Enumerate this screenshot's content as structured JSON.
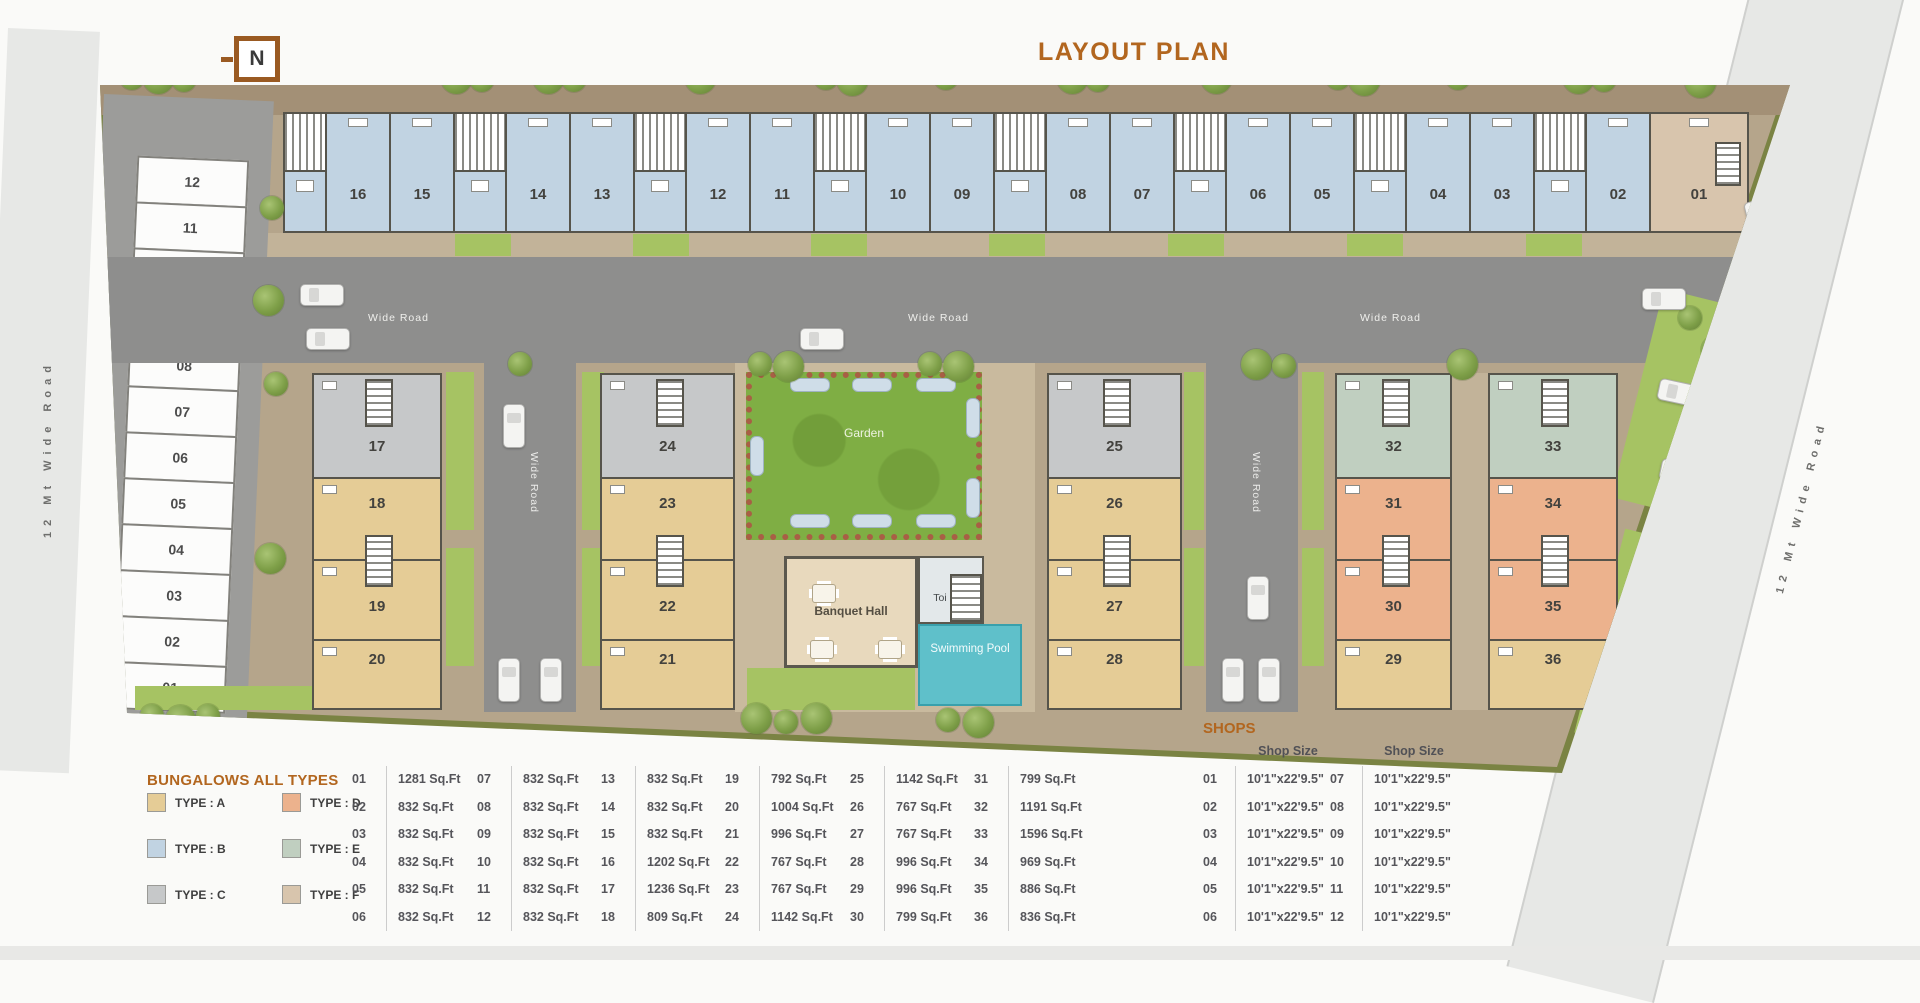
{
  "title": "LAYOUT PLAN",
  "north_label": "N",
  "accent_color": "#b2661f",
  "roads": {
    "left_label": "12 Mt Wide Road",
    "right_label": "12 Mt Wide Road",
    "horizontal_label": "Wide Road",
    "vertical_label": "Wide Road"
  },
  "amenities": {
    "garden": "Garden",
    "banquet_hall": "Banquet Hall",
    "toilet": "Toi",
    "swimming_pool": "Swimming Pool"
  },
  "top_row_units": [
    {
      "no": "16",
      "type": "B"
    },
    {
      "no": "15",
      "type": "B"
    },
    {
      "no": "14",
      "type": "B"
    },
    {
      "no": "13",
      "type": "B"
    },
    {
      "no": "12",
      "type": "B"
    },
    {
      "no": "11",
      "type": "B"
    },
    {
      "no": "10",
      "type": "B"
    },
    {
      "no": "09",
      "type": "B"
    },
    {
      "no": "08",
      "type": "B"
    },
    {
      "no": "07",
      "type": "B"
    },
    {
      "no": "06",
      "type": "B"
    },
    {
      "no": "05",
      "type": "B"
    },
    {
      "no": "04",
      "type": "B"
    },
    {
      "no": "03",
      "type": "B"
    },
    {
      "no": "02",
      "type": "B"
    },
    {
      "no": "01",
      "type": "F"
    }
  ],
  "clusters": [
    {
      "units": [
        {
          "no": "17",
          "type": "C"
        },
        {
          "no": "18",
          "type": "A"
        },
        {
          "no": "19",
          "type": "A"
        },
        {
          "no": "20",
          "type": "A"
        }
      ]
    },
    {
      "units": [
        {
          "no": "24",
          "type": "C"
        },
        {
          "no": "23",
          "type": "A"
        },
        {
          "no": "22",
          "type": "A"
        },
        {
          "no": "21",
          "type": "A"
        }
      ]
    },
    {
      "units": [
        {
          "no": "25",
          "type": "C"
        },
        {
          "no": "26",
          "type": "A"
        },
        {
          "no": "27",
          "type": "A"
        },
        {
          "no": "28",
          "type": "A"
        }
      ]
    },
    {
      "units": [
        {
          "no": "32",
          "type": "E"
        },
        {
          "no": "31",
          "type": "D"
        },
        {
          "no": "30",
          "type": "D"
        },
        {
          "no": "29",
          "type": "A"
        }
      ]
    },
    {
      "units": [
        {
          "no": "33",
          "type": "E"
        },
        {
          "no": "34",
          "type": "D"
        },
        {
          "no": "35",
          "type": "D"
        },
        {
          "no": "36",
          "type": "A"
        }
      ]
    }
  ],
  "shop_slots": [
    "12",
    "11",
    "10",
    "09",
    "08",
    "07",
    "06",
    "05",
    "04",
    "03",
    "02",
    "01"
  ],
  "legend": {
    "title": "BUNGALOWS ALL TYPES",
    "items": [
      {
        "label": "TYPE : A",
        "color": "#e5cc96"
      },
      {
        "label": "TYPE : B",
        "color": "#c1d3e2"
      },
      {
        "label": "TYPE : C",
        "color": "#c6c8c9"
      },
      {
        "label": "TYPE : D",
        "color": "#ecb28d"
      },
      {
        "label": "TYPE : E",
        "color": "#c0cfc0"
      },
      {
        "label": "TYPE : F",
        "color": "#d8c5ad"
      }
    ]
  },
  "bungalow_table": {
    "columns": [
      [
        {
          "no": "01",
          "size": "1281 Sq.Ft"
        },
        {
          "no": "02",
          "size": "832 Sq.Ft"
        },
        {
          "no": "03",
          "size": "832 Sq.Ft"
        },
        {
          "no": "04",
          "size": "832 Sq.Ft"
        },
        {
          "no": "05",
          "size": "832 Sq.Ft"
        },
        {
          "no": "06",
          "size": "832 Sq.Ft"
        }
      ],
      [
        {
          "no": "07",
          "size": "832 Sq.Ft"
        },
        {
          "no": "08",
          "size": "832 Sq.Ft"
        },
        {
          "no": "09",
          "size": "832 Sq.Ft"
        },
        {
          "no": "10",
          "size": "832 Sq.Ft"
        },
        {
          "no": "11",
          "size": "832 Sq.Ft"
        },
        {
          "no": "12",
          "size": "832 Sq.Ft"
        }
      ],
      [
        {
          "no": "13",
          "size": "832 Sq.Ft"
        },
        {
          "no": "14",
          "size": "832 Sq.Ft"
        },
        {
          "no": "15",
          "size": "832 Sq.Ft"
        },
        {
          "no": "16",
          "size": "1202 Sq.Ft"
        },
        {
          "no": "17",
          "size": "1236 Sq.Ft"
        },
        {
          "no": "18",
          "size": "809 Sq.Ft"
        }
      ],
      [
        {
          "no": "19",
          "size": "792 Sq.Ft"
        },
        {
          "no": "20",
          "size": "1004 Sq.Ft"
        },
        {
          "no": "21",
          "size": "996 Sq.Ft"
        },
        {
          "no": "22",
          "size": "767 Sq.Ft"
        },
        {
          "no": "23",
          "size": "767 Sq.Ft"
        },
        {
          "no": "24",
          "size": "1142 Sq.Ft"
        }
      ],
      [
        {
          "no": "25",
          "size": "1142 Sq.Ft"
        },
        {
          "no": "26",
          "size": "767 Sq.Ft"
        },
        {
          "no": "27",
          "size": "767 Sq.Ft"
        },
        {
          "no": "28",
          "size": "996 Sq.Ft"
        },
        {
          "no": "29",
          "size": "996 Sq.Ft"
        },
        {
          "no": "30",
          "size": "799 Sq.Ft"
        }
      ],
      [
        {
          "no": "31",
          "size": "799 Sq.Ft"
        },
        {
          "no": "32",
          "size": "1191 Sq.Ft"
        },
        {
          "no": "33",
          "size": "1596 Sq.Ft"
        },
        {
          "no": "34",
          "size": "969 Sq.Ft"
        },
        {
          "no": "35",
          "size": "886 Sq.Ft"
        },
        {
          "no": "36",
          "size": "836 Sq.Ft"
        }
      ]
    ]
  },
  "shops": {
    "title": "SHOPS",
    "size_header": "Shop Size",
    "columns": [
      [
        {
          "no": "01",
          "size": "10'1\"x22'9.5\""
        },
        {
          "no": "02",
          "size": "10'1\"x22'9.5\""
        },
        {
          "no": "03",
          "size": "10'1\"x22'9.5\""
        },
        {
          "no": "04",
          "size": "10'1\"x22'9.5\""
        },
        {
          "no": "05",
          "size": "10'1\"x22'9.5\""
        },
        {
          "no": "06",
          "size": "10'1\"x22'9.5\""
        }
      ],
      [
        {
          "no": "07",
          "size": "10'1\"x22'9.5\""
        },
        {
          "no": "08",
          "size": "10'1\"x22'9.5\""
        },
        {
          "no": "09",
          "size": "10'1\"x22'9.5\""
        },
        {
          "no": "10",
          "size": "10'1\"x22'9.5\""
        },
        {
          "no": "11",
          "size": "10'1\"x22'9.5\""
        },
        {
          "no": "12",
          "size": "10'1\"x22'9.5\""
        }
      ]
    ]
  }
}
